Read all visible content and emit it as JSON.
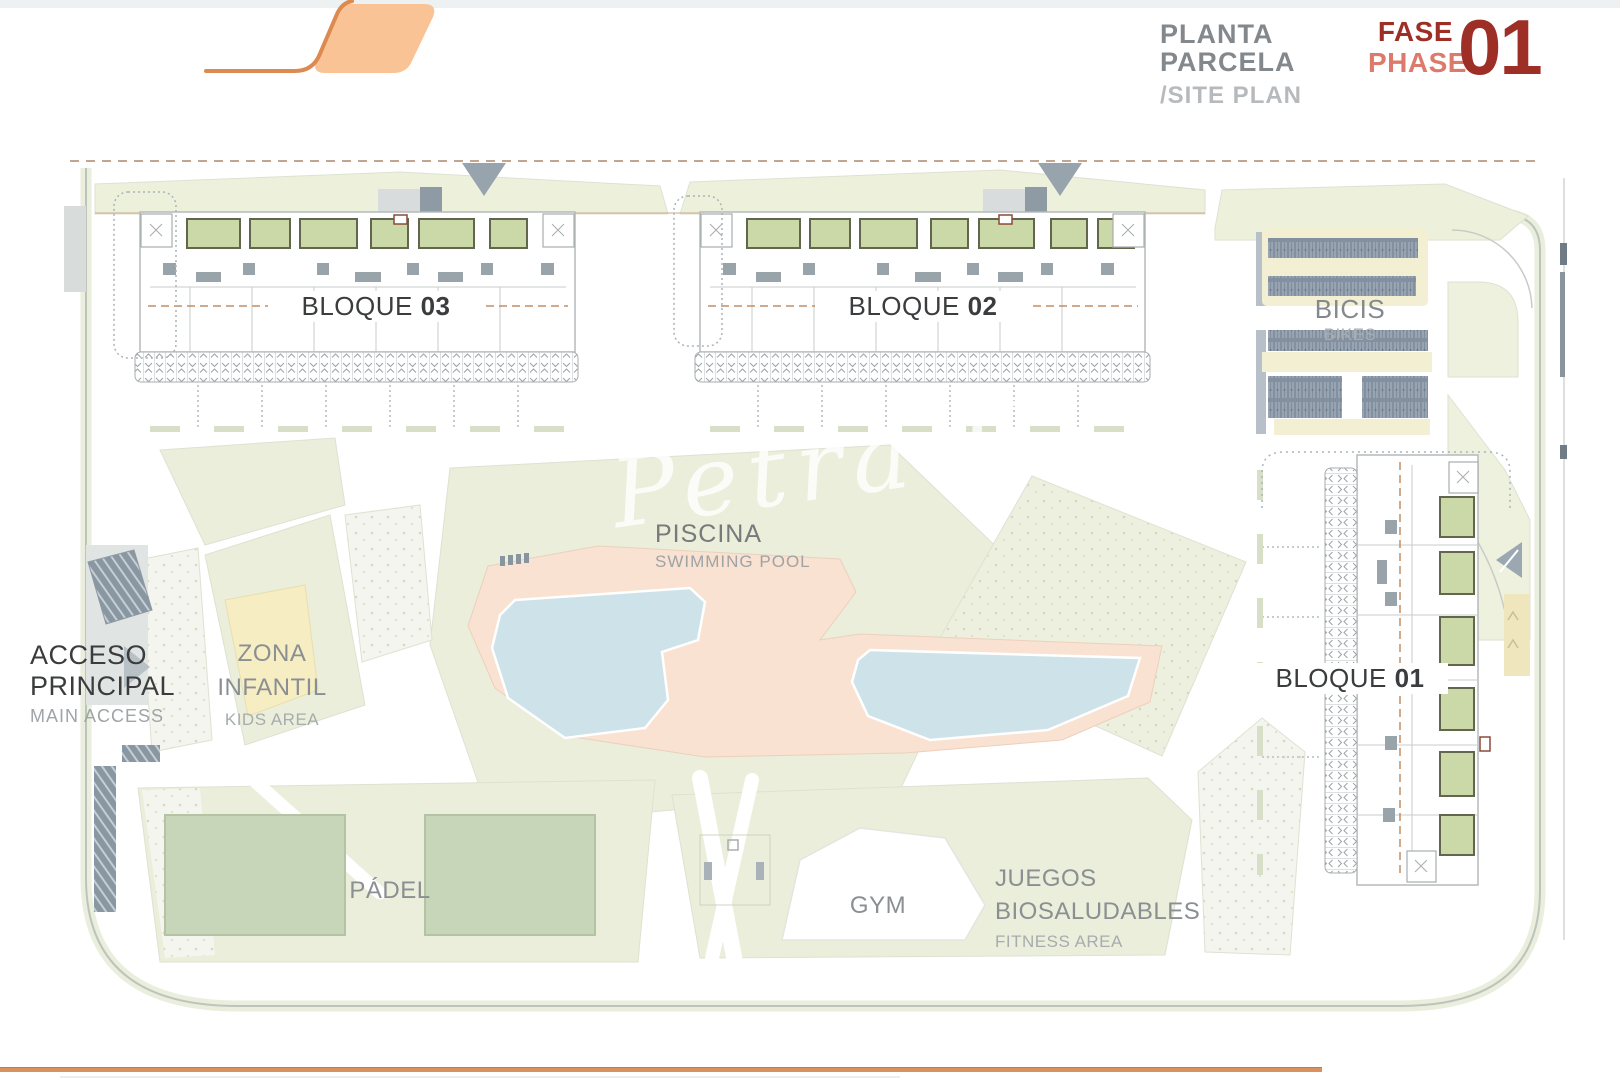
{
  "header": {
    "title_es": "PLANTA PARCELA",
    "title_en": "/SITE PLAN",
    "fase_es": "FASE",
    "fase_en": "PHASE",
    "phase_number": "01"
  },
  "map": {
    "bloque03": {
      "name": "BLOQUE",
      "num": "03"
    },
    "bloque02": {
      "name": "BLOQUE",
      "num": "02"
    },
    "bloque01": {
      "name": "BLOQUE",
      "num": "01"
    },
    "piscina": {
      "es": "PISCINA",
      "en": "SWIMMING POOL"
    },
    "zona_infantil": {
      "es1": "ZONA",
      "es2": "INFANTIL",
      "en": "KIDS AREA"
    },
    "acceso": {
      "es1": "ACCESO",
      "es2": "PRINCIPAL",
      "en": "MAIN ACCESS"
    },
    "padel": {
      "es": "PÁDEL"
    },
    "gym": {
      "es": "GYM"
    },
    "juegos": {
      "es1": "JUEGOS",
      "es2": "BIOSALUDABLES",
      "en": "FITNESS AREA"
    },
    "bicis": {
      "es": "BICIS",
      "en": "BIKES"
    },
    "watermark": "Petra H"
  },
  "colors": {
    "accent_orange": "#dc8a50",
    "logo_fill": "#f9c395",
    "phase_dark": "#9e2f27",
    "phase_light": "#dc7a6c",
    "title_gray": "#83888d",
    "subtitle_gray": "#b7babc",
    "label_dark": "#3a3c3d",
    "label_gray": "#8a8f92",
    "label_light": "#a7acaf",
    "lawn_green": "#eaeeda",
    "patio_green": "#cbd9a9",
    "pool_water": "#cee2e9",
    "pool_deck": "#f9e2d1",
    "kids_yellow": "#f6edc2",
    "rack_slate": "#8290a0",
    "bike_beige": "#f3efd2"
  }
}
